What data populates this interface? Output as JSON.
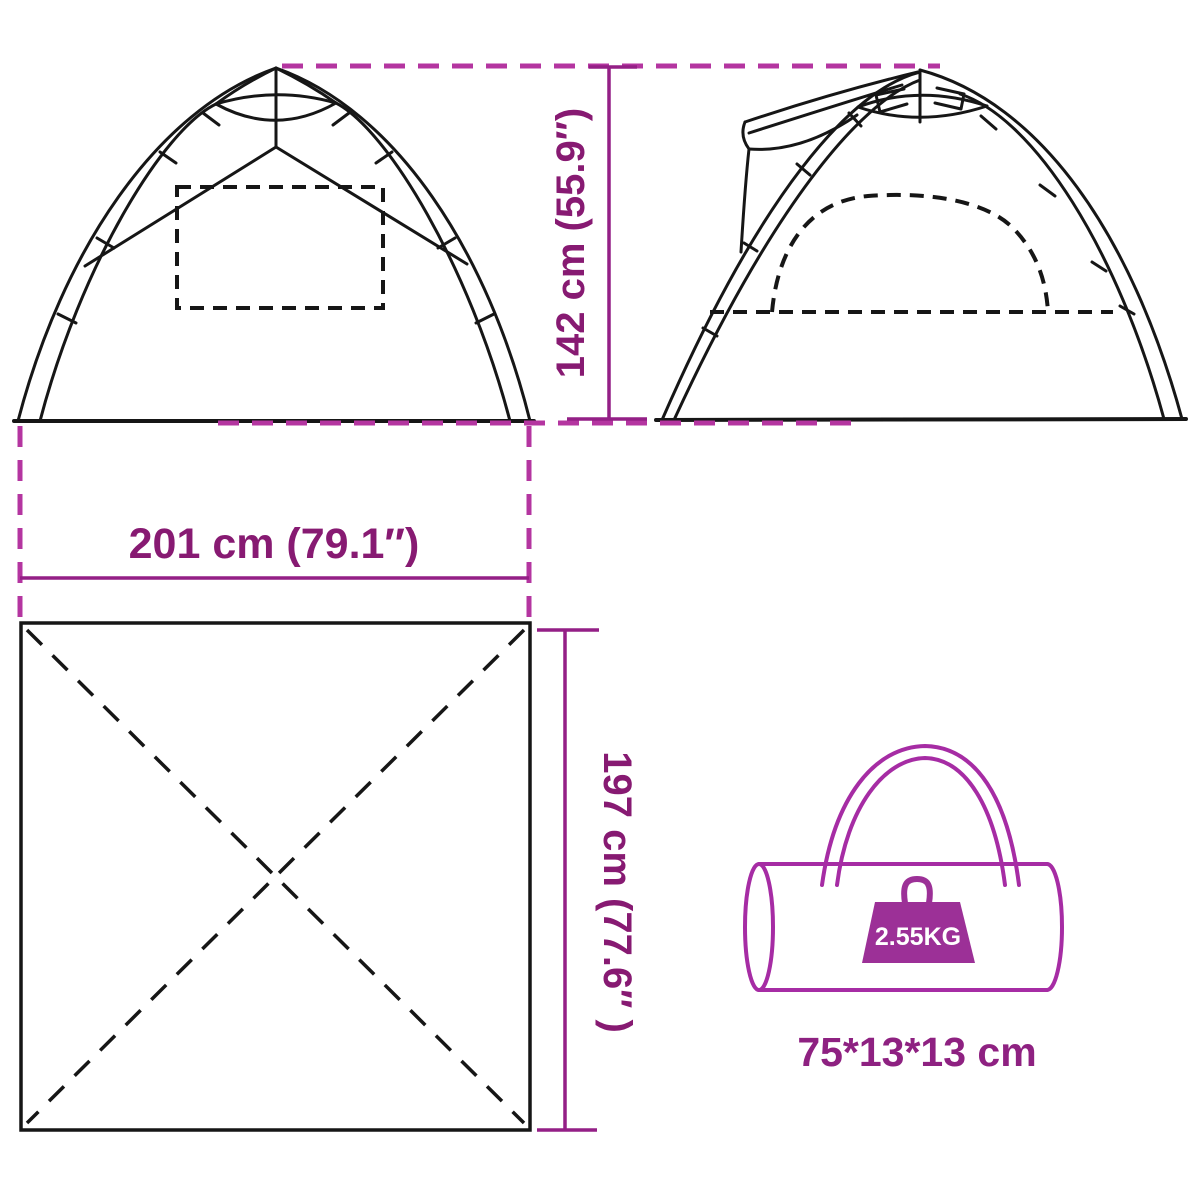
{
  "diagram_title": "tent-dimension-diagram",
  "dimensions": {
    "height_label": "142 cm (55.9″)",
    "width_label": "201 cm (79.1″)",
    "floor_depth_label": "197 cm (77.6″ )"
  },
  "packed_bag": {
    "weight_label": "2.55KG",
    "size_label": "75*13*13 cm"
  },
  "icons": [
    "tent-front-view",
    "tent-side-view",
    "floor-plan",
    "carry-bag-icon",
    "weight-icon"
  ],
  "colors": {
    "dimension_text": "#871a72",
    "dimension_line": "#941f86",
    "dimension_dashed": "#b435a0",
    "bag_outline": "#a62ca4",
    "weight_fill": "#9c3097",
    "drawing_line": "#161616",
    "background": "#ffffff"
  }
}
